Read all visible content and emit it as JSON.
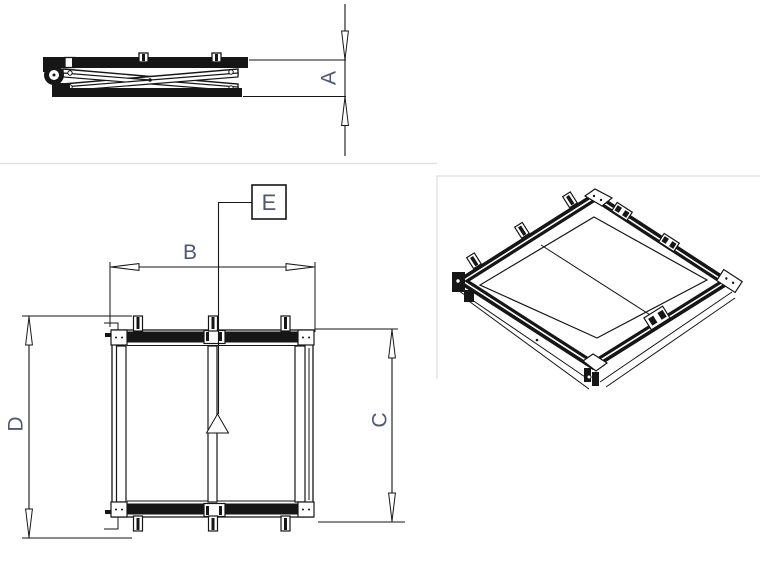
{
  "drawing": {
    "labels": {
      "a": "A",
      "b": "B",
      "c": "C",
      "d": "D",
      "e": "E"
    },
    "colors": {
      "ink": "#161616",
      "label": "#4d5878",
      "divider": "#dedede",
      "bg": "#ffffff"
    }
  }
}
